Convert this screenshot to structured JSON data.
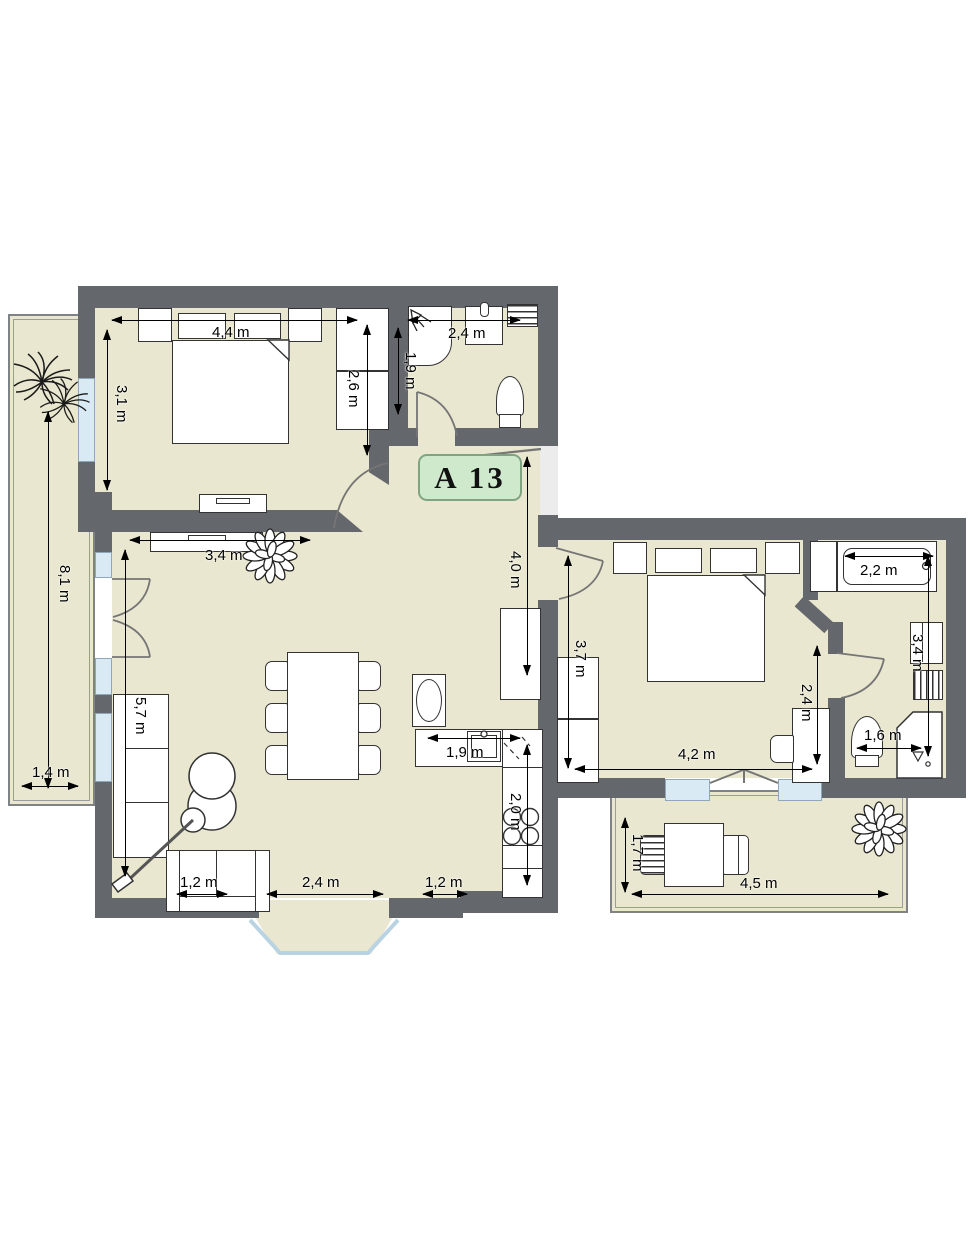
{
  "floorplan": {
    "unit_label": "A 13",
    "colors": {
      "wall": "#64676c",
      "floor": "#e9e7cf",
      "window": "#d9eaf5",
      "window_border": "#8ea8ba",
      "furniture_outline": "#333333",
      "label_bg": "#cfe9cc",
      "label_border": "#7fa580",
      "dimension": "#000000",
      "door": "#757575",
      "glass": "#b9d3e3"
    },
    "dimensions": {
      "bedroom1_width": "4,4 m",
      "bedroom1_depth": "3,1 m",
      "bedroom1_wardrobe": "2,6 m",
      "bath1_width": "2,4 m",
      "bath1_depth": "1,9 m",
      "hall_length": "4,0 m",
      "sideboard_width": "3,4 m",
      "living_depth": "5,7 m",
      "balcony_left_length": "8,1 m",
      "balcony_left_width": "1,4 m",
      "sofa_small_width": "1,2 m",
      "living_clearance": "2,4 m",
      "kitchen_clearance": "1,2 m",
      "kitchen_counter": "1,9 m",
      "kitchen_run": "2,0 m",
      "bedroom2_depth": "3,7 m",
      "bedroom2_width": "4,2 m",
      "bedroom2_side": "2,4 m",
      "bathtub_width": "2,2 m",
      "bath2_depth": "3,4 m",
      "bath2_width": "1,6 m",
      "balcony_right_depth": "1,7 m",
      "balcony_right_width": "4,5 m"
    }
  }
}
